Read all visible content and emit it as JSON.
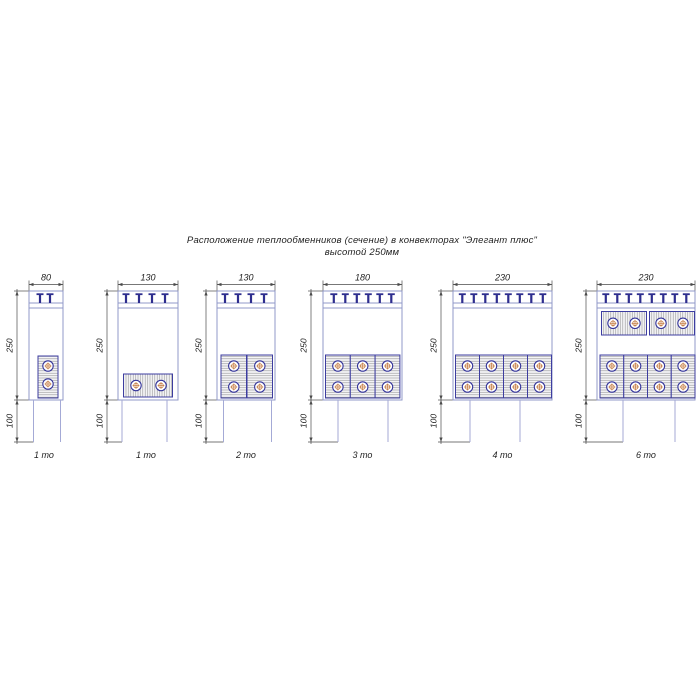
{
  "title": {
    "line1": "Расположение теплообменников (сечение) в конвекторах \"Элегант плюс\"",
    "line2": "высотой 250мм"
  },
  "drawing": {
    "colors": {
      "outline": "#9098c8",
      "duct_outline": "#a4aad6",
      "grille_tee": "#2d2d8e",
      "module_border": "#3d3da0",
      "hatch": "#9a9a9a",
      "tube_ring": "#34349a",
      "tube_center": "#c2763a",
      "dim": "#4a4a4a",
      "text": "#1f1f1f"
    },
    "layout": {
      "body_top": 291,
      "body_bottom": 400,
      "duct_bottom": 442,
      "grille_lines": [
        303,
        308
      ],
      "top_dim_y": 284.5,
      "top_dim_label_y": 280.5,
      "label_y": 458,
      "dim_font_size": 8.5,
      "label_font_size": 9
    },
    "height_dim_label": "250",
    "duct_dim_label": "100",
    "diagrams": [
      {
        "name": "convector-80-1to",
        "width_label": "80",
        "type_label": "1 то",
        "label_cx": 44,
        "body": {
          "x": 29,
          "w": 34
        },
        "duct": {
          "x": 33.5,
          "w": 27
        },
        "dim_line_x": 17,
        "tees": [
          40,
          50
        ],
        "modules": [
          {
            "hatch": "h",
            "x": 38,
            "y": 356,
            "w": 20,
            "h": 42,
            "tubes": [
              [
                48,
                366
              ],
              [
                48,
                384
              ]
            ]
          }
        ]
      },
      {
        "name": "convector-130-1to",
        "width_label": "130",
        "type_label": "1 то",
        "label_cx": 146,
        "body": {
          "x": 118,
          "w": 60
        },
        "duct": {
          "x": 122,
          "w": 45
        },
        "dim_line_x": 107,
        "tees": [
          126,
          139,
          152,
          165
        ],
        "modules": [
          {
            "hatch": "v",
            "x": 123.5,
            "y": 374,
            "w": 49,
            "h": 23,
            "tubes": [
              [
                136,
                385.5
              ],
              [
                161,
                385.5
              ]
            ]
          }
        ]
      },
      {
        "name": "convector-130-2to",
        "width_label": "130",
        "type_label": "2 то",
        "label_cx": 246,
        "body": {
          "x": 217,
          "w": 58
        },
        "duct": {
          "x": 223.5,
          "w": 48
        },
        "dim_line_x": 206,
        "tees": [
          225,
          238,
          251,
          264
        ],
        "modules": [
          {
            "hatch": "h",
            "x": 221,
            "y": 355,
            "w": 25.5,
            "h": 43,
            "tubes": [
              [
                233.8,
                366
              ],
              [
                233.8,
                387
              ]
            ]
          },
          {
            "hatch": "h",
            "x": 247,
            "y": 355,
            "w": 25.5,
            "h": 43,
            "tubes": [
              [
                259.8,
                366
              ],
              [
                259.8,
                387
              ]
            ]
          }
        ]
      },
      {
        "name": "convector-180-3to",
        "width_label": "180",
        "type_label": "3 то",
        "label_cx": 362.5,
        "body": {
          "x": 323,
          "w": 79
        },
        "duct": {
          "x": 338,
          "w": 50
        },
        "dim_line_x": 311,
        "tees": [
          333.8,
          345.3,
          356.8,
          368.3,
          379.8,
          391.3
        ],
        "modules": [
          {
            "hatch": "h",
            "x": 325.5,
            "y": 355,
            "w": 24.8,
            "h": 43,
            "tubes": [
              [
                337.9,
                366
              ],
              [
                337.9,
                387
              ]
            ]
          },
          {
            "hatch": "h",
            "x": 350.3,
            "y": 355,
            "w": 24.8,
            "h": 43,
            "tubes": [
              [
                362.7,
                366
              ],
              [
                362.7,
                387
              ]
            ]
          },
          {
            "hatch": "h",
            "x": 375.1,
            "y": 355,
            "w": 24.8,
            "h": 43,
            "tubes": [
              [
                387.5,
                366
              ],
              [
                387.5,
                387
              ]
            ]
          }
        ]
      },
      {
        "name": "convector-230-4to",
        "width_label": "230",
        "type_label": "4 то",
        "label_cx": 502.5,
        "body": {
          "x": 453,
          "w": 99
        },
        "duct": {
          "x": 470,
          "w": 50
        },
        "dim_line_x": 441,
        "tees": [
          462.3,
          473.8,
          485.3,
          496.8,
          508.3,
          519.8,
          531.3,
          542.8
        ],
        "modules": [
          {
            "hatch": "h",
            "x": 455.5,
            "y": 355,
            "w": 24,
            "h": 43,
            "tubes": [
              [
                467.5,
                366
              ],
              [
                467.5,
                387
              ]
            ]
          },
          {
            "hatch": "h",
            "x": 479.5,
            "y": 355,
            "w": 24,
            "h": 43,
            "tubes": [
              [
                491.5,
                366
              ],
              [
                491.5,
                387
              ]
            ]
          },
          {
            "hatch": "h",
            "x": 503.5,
            "y": 355,
            "w": 24,
            "h": 43,
            "tubes": [
              [
                515.5,
                366
              ],
              [
                515.5,
                387
              ]
            ]
          },
          {
            "hatch": "h",
            "x": 527.5,
            "y": 355,
            "w": 24,
            "h": 43,
            "tubes": [
              [
                539.5,
                366
              ],
              [
                539.5,
                387
              ]
            ]
          }
        ]
      },
      {
        "name": "convector-230-6to",
        "width_label": "230",
        "type_label": "6 то",
        "label_cx": 646,
        "body": {
          "x": 597,
          "w": 98
        },
        "duct": {
          "x": 623,
          "w": 52
        },
        "dim_line_x": 586,
        "tees": [
          605.8,
          617.3,
          628.8,
          640.3,
          651.8,
          663.3,
          674.8,
          686.3
        ],
        "modules": [
          {
            "hatch": "v",
            "x": 601.5,
            "y": 311.5,
            "w": 45,
            "h": 23.5,
            "tubes": [
              [
                613,
                323.3
              ],
              [
                635,
                323.3
              ]
            ]
          },
          {
            "hatch": "v",
            "x": 649.5,
            "y": 311.5,
            "w": 45,
            "h": 23.5,
            "tubes": [
              [
                661,
                323.3
              ],
              [
                683,
                323.3
              ]
            ]
          },
          {
            "hatch": "h",
            "x": 600,
            "y": 355,
            "w": 23.75,
            "h": 43,
            "tubes": [
              [
                611.9,
                366
              ],
              [
                611.9,
                387
              ]
            ]
          },
          {
            "hatch": "h",
            "x": 623.75,
            "y": 355,
            "w": 23.75,
            "h": 43,
            "tubes": [
              [
                635.6,
                366
              ],
              [
                635.6,
                387
              ]
            ]
          },
          {
            "hatch": "h",
            "x": 647.5,
            "y": 355,
            "w": 23.75,
            "h": 43,
            "tubes": [
              [
                659.4,
                366
              ],
              [
                659.4,
                387
              ]
            ]
          },
          {
            "hatch": "h",
            "x": 671.25,
            "y": 355,
            "w": 23.75,
            "h": 43,
            "tubes": [
              [
                683.1,
                366
              ],
              [
                683.1,
                387
              ]
            ]
          }
        ]
      }
    ]
  }
}
